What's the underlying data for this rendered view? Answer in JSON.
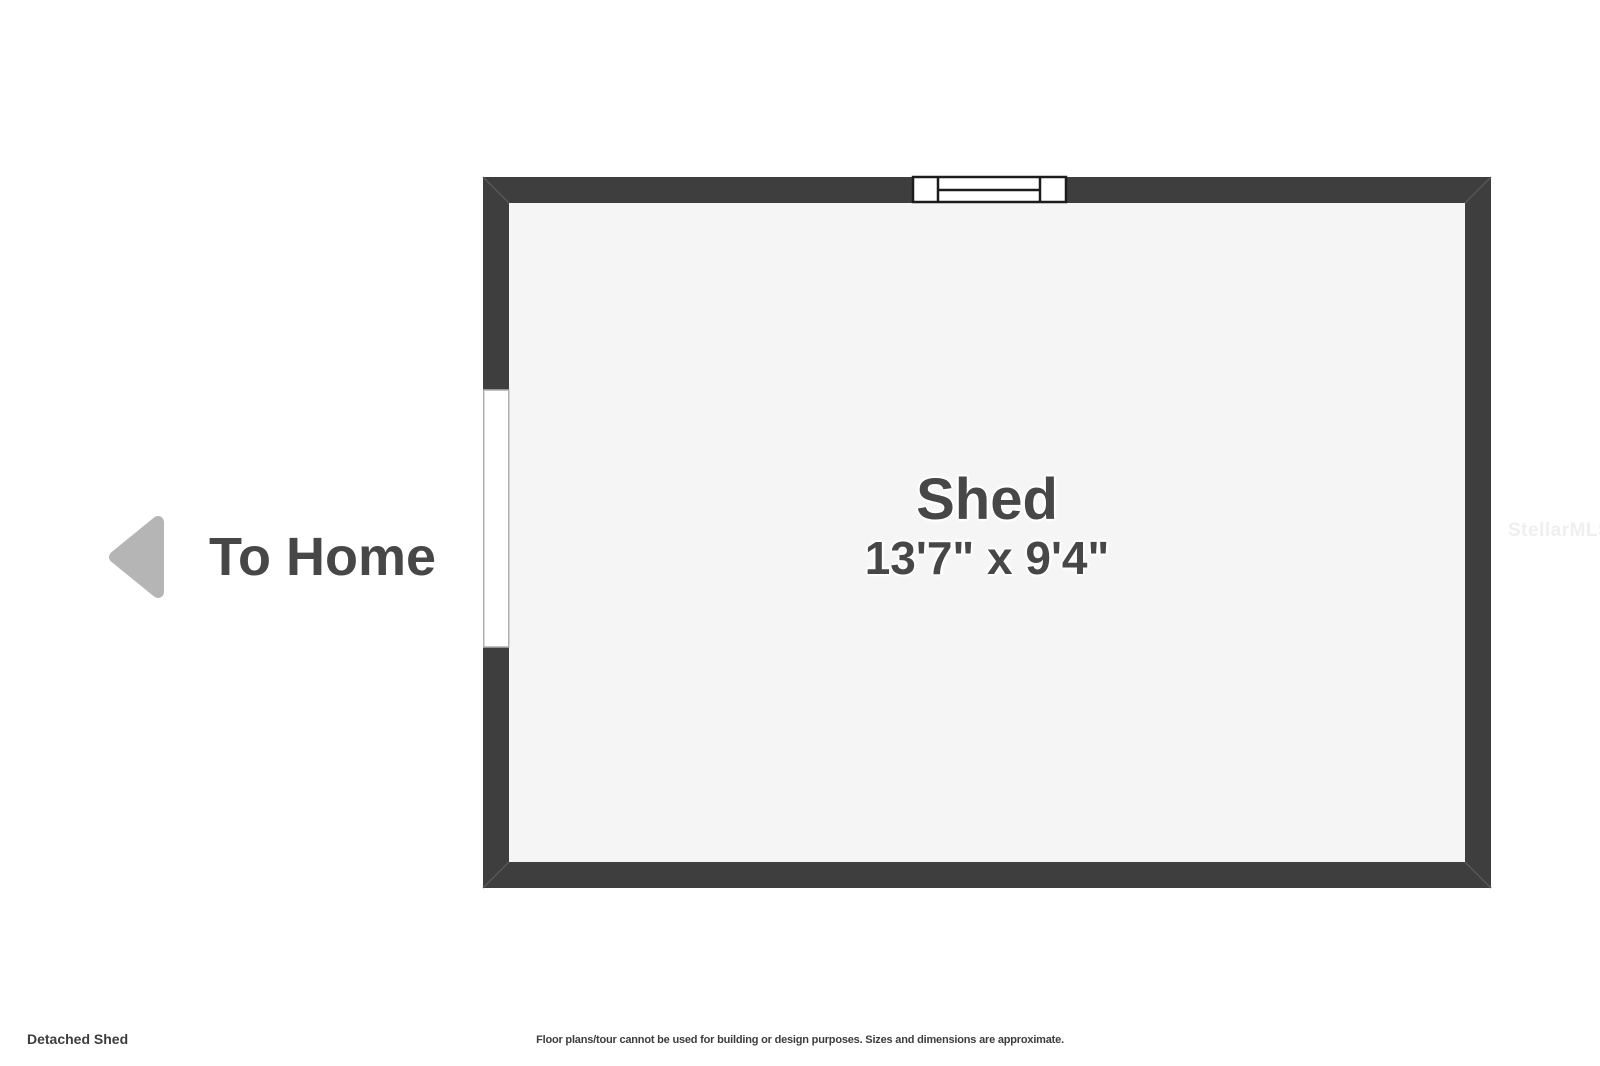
{
  "floorplan": {
    "room": {
      "name": "Shed",
      "dimensions": "13'7\" x 9'4\""
    },
    "navigation": {
      "to_home_label": "To Home",
      "arrow_direction": "left"
    },
    "footer": {
      "plan_title": "Detached Shed",
      "disclaimer": "Floor plans/tour cannot be used for building or design purposes. Sizes and dimensions are approximate."
    },
    "watermark": "StellarMLS",
    "colors": {
      "wall": "#3e3e3e",
      "floor": "#f5f5f5",
      "background": "#ffffff",
      "label_text": "#474747",
      "arrow": "#b5b5b5",
      "watermark_text": "#efefef",
      "window_stroke": "#1c1c1c",
      "window_fill": "#ffffff",
      "door_fill": "#ffffff",
      "door_border": "#b0b0b0",
      "miter_line": "#575757"
    }
  }
}
